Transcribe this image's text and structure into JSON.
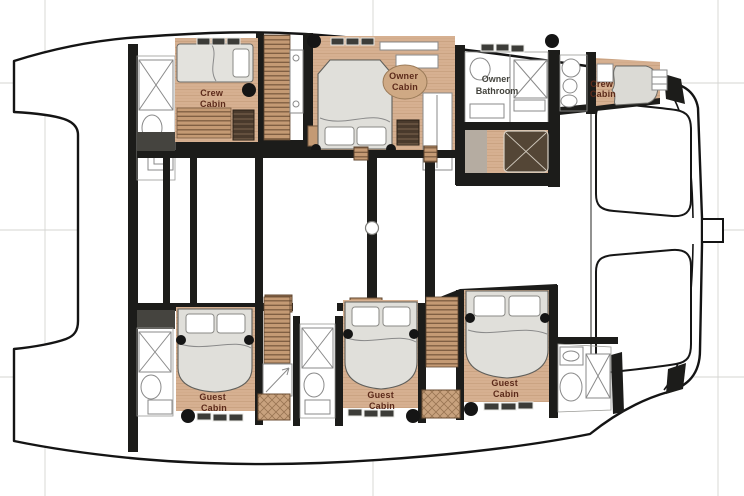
{
  "plan": {
    "title": "catamaran-lower-deck-floor-plan",
    "labels": [
      {
        "id": "crew-cabin-port",
        "line1": "Crew",
        "line2": "Cabin"
      },
      {
        "id": "owner-cabin",
        "line1": "Owner",
        "line2": "Cabin"
      },
      {
        "id": "owner-bathroom",
        "line1": "Owner",
        "line2": "Bathroom"
      },
      {
        "id": "crew-cabin-starboard",
        "line1": "Crew",
        "line2": "Cabin"
      },
      {
        "id": "guest-cabin-port",
        "line1": "Guest",
        "line2": "Cabin"
      },
      {
        "id": "guest-cabin-mid",
        "line1": "Guest",
        "line2": "Cabin"
      },
      {
        "id": "guest-cabin-starboard",
        "line1": "Guest",
        "line2": "Cabin"
      }
    ],
    "colors": {
      "wall": "#1c1c1a",
      "hull_outline": "#141414",
      "wood_floor": "#d6b091",
      "stair_wood": "#c49a74",
      "locker_wood": "#c8a27e",
      "bed": "#e3e2dd",
      "carpet": "#c9c4bb",
      "dark_furniture": "#544636",
      "cabin_label_text": "#5c2a1a",
      "bathroom_label_text": "#44443e",
      "construction_line": "#d4d4d2",
      "window": "#3c3c38"
    }
  }
}
